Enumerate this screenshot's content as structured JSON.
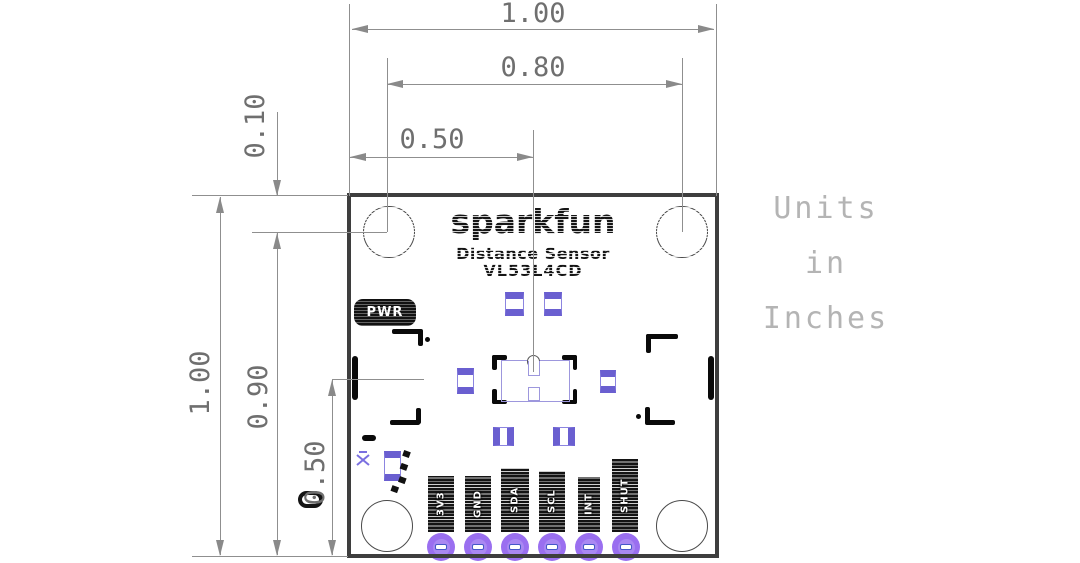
{
  "note": {
    "line1": "Units",
    "line2": "in",
    "line3": "Inches"
  },
  "dimensions": {
    "top": [
      {
        "label": "1.00"
      },
      {
        "label": "0.80"
      },
      {
        "label": "0.50"
      }
    ],
    "left": [
      {
        "label": "0.10"
      },
      {
        "label": "1.00"
      },
      {
        "label": "0.90"
      },
      {
        "label": "0.50"
      }
    ]
  },
  "board": {
    "logo": "sparkfun",
    "product_line1": "Distance Sensor",
    "product_line2": "VL53L4CD",
    "pwr_led_label": "PWR",
    "pins": [
      {
        "label": "3V3"
      },
      {
        "label": "GND"
      },
      {
        "label": "SDA"
      },
      {
        "label": "SCL"
      },
      {
        "label": "INT"
      },
      {
        "label": "SHUT"
      }
    ]
  },
  "colors": {
    "board_outline": "#3e3e3e",
    "dimension_gray": "#8a8a8a",
    "dimension_text": "#6f6f6f",
    "note_text": "#b4b4b4",
    "pad_purple": "#6a5fd0",
    "sensor_outline_purple": "#9d97dd",
    "through_hole_purple": "#9a6ff0"
  }
}
